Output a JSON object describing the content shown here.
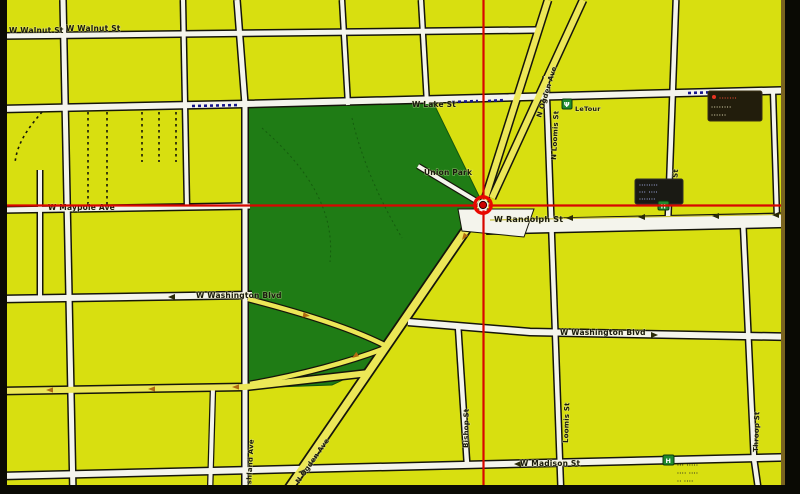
{
  "colors": {
    "background": "#d8df10",
    "park": "#1f7c15",
    "road_white": "#f4f4ec",
    "road_yellow": "#ece757",
    "casing": "#15150a",
    "crosshair": "#d80600",
    "rail_blue": "#15158c",
    "poi_green": "#1f8a2f",
    "poi_red": "#e83422"
  },
  "labels": {
    "walnut_w": "W Walnut St",
    "walnut_e": "W Walnut St",
    "lake": "W Lake St",
    "maypole": "W Maypole Ave",
    "randolph": "W Randolph St",
    "washington_w": "W Washington Blvd",
    "washington_e": "W Washington Blvd",
    "madison": "W Madison St",
    "ogden_n": "N Ogden Ave",
    "ogden_s": "N Ogden Ave",
    "loomis_n": "N Loomis St",
    "loomis_s": "Loomis St",
    "ada": "N Ada St",
    "bishop": "Bishop St",
    "throop": "Throop St",
    "ashland": "Ashland Ave",
    "union_park": "Union Park"
  },
  "pois": {
    "letour": {
      "name": "LeTour"
    },
    "top_right": {
      "line1": "·······",
      "line2": "········",
      "line3": "······"
    },
    "ada_randolph": {
      "line1": "········",
      "line2": "··· ····",
      "line3": "·······"
    },
    "bottom_right": {
      "line1": "··· ·····",
      "line2": "···· ····",
      "line3": "·· ····"
    }
  }
}
